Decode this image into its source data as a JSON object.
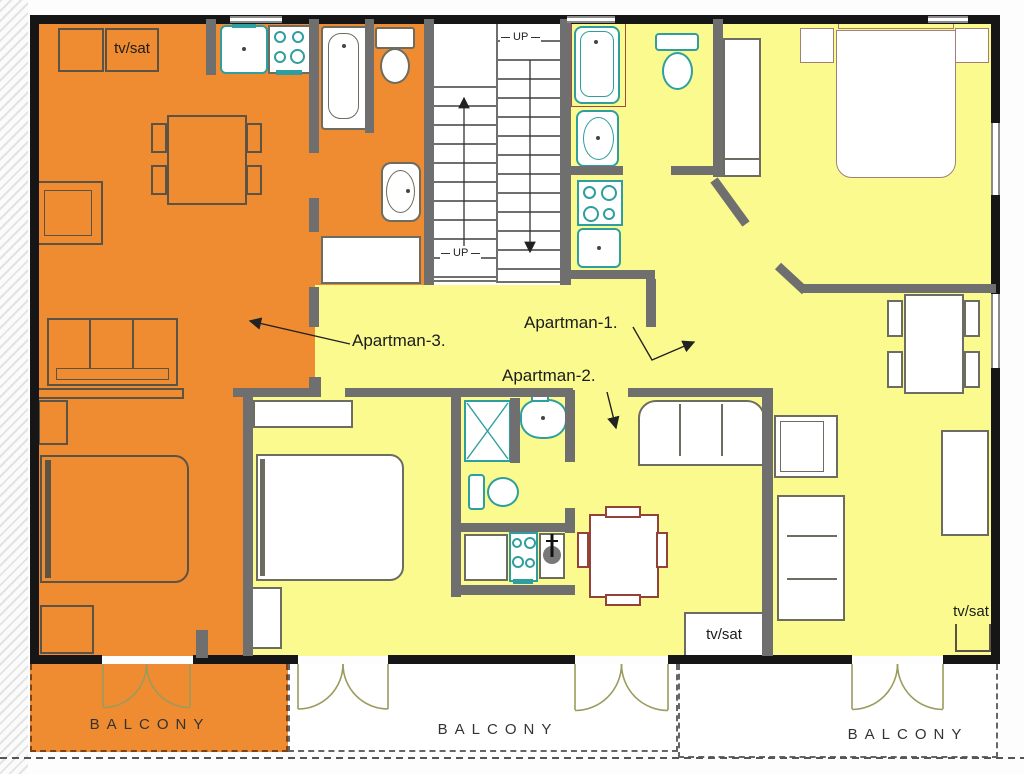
{
  "title": "Apartment floor plan",
  "colors": {
    "apartment_1_2_floor": "#fafa8f",
    "apartment_3_floor": "#ef8b30",
    "interior_wall": "#6f6f6f",
    "exterior_wall": "#161616",
    "fixture_teal": "#2f9e9e",
    "furniture_red": "#93423a",
    "door_swing": "#9b9b5e"
  },
  "labels": {
    "apartman_1": "Apartman-1.",
    "apartman_2": "Apartman-2.",
    "apartman_3": "Apartman-3.",
    "tv_sat": "tv/sat",
    "balcony": "BALCONY",
    "up": "UP"
  },
  "apartments": [
    {
      "name": "Apartman-1.",
      "floor_color": "#fafa8f",
      "features": [
        "double-bed",
        "nightstands",
        "wardrobe",
        "bathtub",
        "washbasin",
        "stove",
        "small-sink",
        "toilet",
        "dining-table-4-chairs",
        "sofa",
        "armchair",
        "sideboard",
        "tv-sat-unit",
        "balcony"
      ]
    },
    {
      "name": "Apartman-2.",
      "floor_color": "#fafa8f",
      "features": [
        "double-bed",
        "nightstand",
        "wardrobe-shelf",
        "shower",
        "washbasin",
        "toilet",
        "kitchen-counter",
        "stove",
        "sink",
        "dining-table-4-chairs",
        "sofa",
        "tv-sat-unit",
        "balcony"
      ]
    },
    {
      "name": "Apartman-3.",
      "floor_color": "#ef8b30",
      "features": [
        "double-bed",
        "nightstand",
        "sofa",
        "armchair",
        "dining-table-4-chairs",
        "kitchen-sink",
        "stove",
        "bathtub",
        "toilet",
        "washbasin",
        "tv-sat-cabinet",
        "balcony"
      ]
    }
  ],
  "stairwell": {
    "label": "UP",
    "flights": 2
  },
  "balconies": [
    "BALCONY",
    "BALCONY",
    "BALCONY"
  ]
}
